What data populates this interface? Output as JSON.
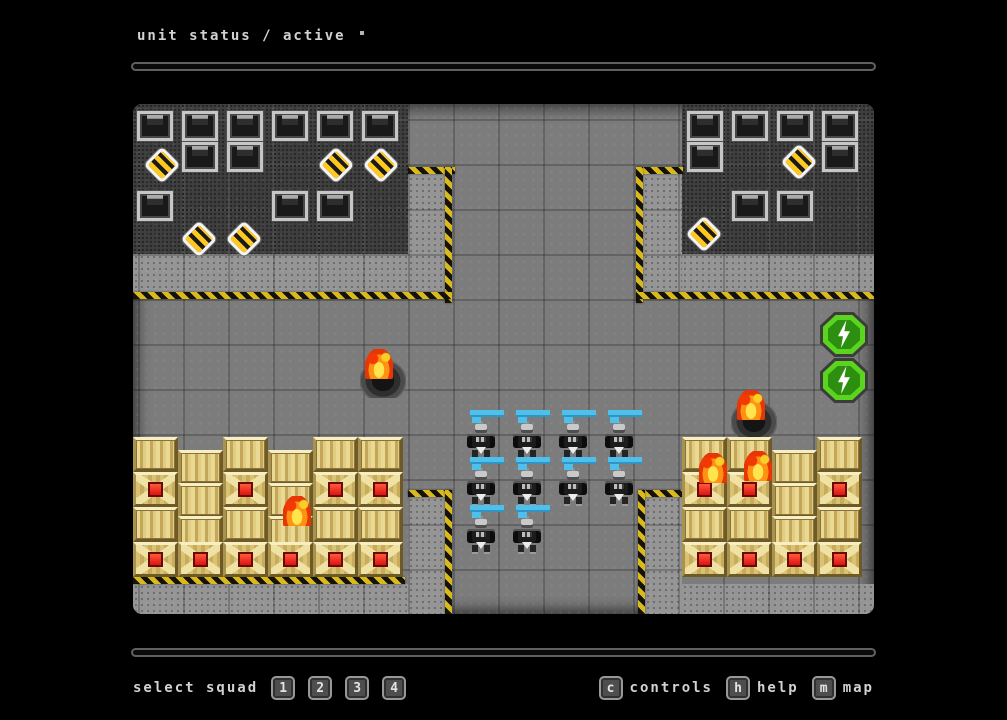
{
  "header": {
    "title": "unit status / active"
  },
  "footer": {
    "select_squad_label": "select squad",
    "squad_keys": [
      "1",
      "2",
      "3",
      "4"
    ],
    "shortcuts": [
      {
        "key": "c",
        "label": "controls"
      },
      {
        "key": "h",
        "label": "help"
      },
      {
        "key": "m",
        "label": "map"
      }
    ]
  },
  "colors": {
    "background": "#000000",
    "floor": "#7c7c7c",
    "dark_zone": "#3f3f3f",
    "concrete": "#959595",
    "hazard_yellow": "#d9b91c",
    "health_bar_cyan": "#4fc0ea",
    "energy_green": "#5bd41f",
    "fire_orange": "#ff9212",
    "crate_tan": "#d9c272",
    "crate_core_red": "#dd1212"
  },
  "board": {
    "tile_size": 45,
    "zones": [
      {
        "type": "dark",
        "x": 0,
        "y": 0,
        "w": 275,
        "h": 150
      },
      {
        "type": "dark",
        "x": 549,
        "y": 0,
        "w": 192,
        "h": 150
      },
      {
        "type": "concrete",
        "x": 275,
        "y": 66,
        "w": 42,
        "h": 129
      },
      {
        "type": "concrete",
        "x": 0,
        "y": 150,
        "w": 275,
        "h": 45
      },
      {
        "type": "concrete",
        "x": 510,
        "y": 66,
        "w": 39,
        "h": 129
      },
      {
        "type": "concrete",
        "x": 549,
        "y": 150,
        "w": 192,
        "h": 45
      },
      {
        "type": "concrete",
        "x": 275,
        "y": 393,
        "w": 37,
        "h": 117
      },
      {
        "type": "concrete",
        "x": 512,
        "y": 393,
        "w": 37,
        "h": 117
      },
      {
        "type": "concrete",
        "x": 0,
        "y": 480,
        "w": 275,
        "h": 30
      },
      {
        "type": "concrete",
        "x": 549,
        "y": 480,
        "w": 192,
        "h": 30
      }
    ],
    "hazards": [
      {
        "x": 275,
        "y": 63,
        "w": 47,
        "h": 7
      },
      {
        "x": 312,
        "y": 63,
        "w": 7,
        "h": 136
      },
      {
        "x": 0,
        "y": 188,
        "w": 319,
        "h": 7
      },
      {
        "x": 503,
        "y": 63,
        "w": 47,
        "h": 7
      },
      {
        "x": 503,
        "y": 63,
        "w": 7,
        "h": 136
      },
      {
        "x": 503,
        "y": 188,
        "w": 238,
        "h": 7
      },
      {
        "x": 275,
        "y": 386,
        "w": 44,
        "h": 7
      },
      {
        "x": 312,
        "y": 386,
        "w": 7,
        "h": 124
      },
      {
        "x": 0,
        "y": 473,
        "w": 272,
        "h": 7
      },
      {
        "x": 505,
        "y": 386,
        "w": 44,
        "h": 7
      },
      {
        "x": 505,
        "y": 386,
        "w": 7,
        "h": 124
      }
    ],
    "sprites": [
      {
        "t": "metal",
        "x": 4,
        "y": 7
      },
      {
        "t": "metal",
        "x": 49,
        "y": 7
      },
      {
        "t": "metal",
        "x": 94,
        "y": 7
      },
      {
        "t": "metal",
        "x": 139,
        "y": 7
      },
      {
        "t": "metal",
        "x": 184,
        "y": 7
      },
      {
        "t": "metal",
        "x": 229,
        "y": 7
      },
      {
        "t": "metal",
        "x": 49,
        "y": 38
      },
      {
        "t": "metal",
        "x": 94,
        "y": 38
      },
      {
        "t": "metal",
        "x": 4,
        "y": 87
      },
      {
        "t": "metal",
        "x": 139,
        "y": 87
      },
      {
        "t": "metal",
        "x": 184,
        "y": 87
      },
      {
        "t": "metal",
        "x": 554,
        "y": 7
      },
      {
        "t": "metal",
        "x": 599,
        "y": 7
      },
      {
        "t": "metal",
        "x": 644,
        "y": 7
      },
      {
        "t": "metal",
        "x": 689,
        "y": 7
      },
      {
        "t": "metal",
        "x": 554,
        "y": 38
      },
      {
        "t": "metal",
        "x": 689,
        "y": 38
      },
      {
        "t": "metal",
        "x": 599,
        "y": 87
      },
      {
        "t": "metal",
        "x": 644,
        "y": 87
      },
      {
        "t": "diamond",
        "x": 12,
        "y": 44
      },
      {
        "t": "diamond",
        "x": 186,
        "y": 44
      },
      {
        "t": "diamond",
        "x": 231,
        "y": 44
      },
      {
        "t": "diamond",
        "x": 49,
        "y": 118
      },
      {
        "t": "diamond",
        "x": 94,
        "y": 118
      },
      {
        "t": "diamond",
        "x": 649,
        "y": 41
      },
      {
        "t": "diamond",
        "x": 554,
        "y": 113
      },
      {
        "t": "energy",
        "x": 687,
        "y": 208
      },
      {
        "t": "energy",
        "x": 687,
        "y": 254
      },
      {
        "t": "crater",
        "x": 227,
        "y": 256
      },
      {
        "t": "crater",
        "x": 598,
        "y": 297
      },
      {
        "t": "crate",
        "x": 0,
        "y": 333
      },
      {
        "t": "cratex",
        "x": 0,
        "y": 368
      },
      {
        "t": "crate",
        "x": 0,
        "y": 403
      },
      {
        "t": "cratex",
        "x": 0,
        "y": 438
      },
      {
        "t": "crate",
        "x": 45,
        "y": 346
      },
      {
        "t": "crate",
        "x": 45,
        "y": 379
      },
      {
        "t": "crate",
        "x": 45,
        "y": 412
      },
      {
        "t": "cratex",
        "x": 45,
        "y": 438
      },
      {
        "t": "crate",
        "x": 90,
        "y": 333
      },
      {
        "t": "cratex",
        "x": 90,
        "y": 368
      },
      {
        "t": "crate",
        "x": 90,
        "y": 403
      },
      {
        "t": "cratex",
        "x": 90,
        "y": 438
      },
      {
        "t": "crate",
        "x": 135,
        "y": 346
      },
      {
        "t": "crate",
        "x": 135,
        "y": 379
      },
      {
        "t": "crate",
        "x": 135,
        "y": 412
      },
      {
        "t": "cratex",
        "x": 135,
        "y": 438
      },
      {
        "t": "crate",
        "x": 180,
        "y": 333
      },
      {
        "t": "cratex",
        "x": 180,
        "y": 368
      },
      {
        "t": "crate",
        "x": 180,
        "y": 403
      },
      {
        "t": "cratex",
        "x": 180,
        "y": 438
      },
      {
        "t": "crate",
        "x": 225,
        "y": 333
      },
      {
        "t": "cratex",
        "x": 225,
        "y": 368
      },
      {
        "t": "crate",
        "x": 225,
        "y": 403
      },
      {
        "t": "cratex",
        "x": 225,
        "y": 438
      },
      {
        "t": "crate",
        "x": 549,
        "y": 333
      },
      {
        "t": "cratex",
        "x": 549,
        "y": 368
      },
      {
        "t": "crate",
        "x": 549,
        "y": 403
      },
      {
        "t": "cratex",
        "x": 549,
        "y": 438
      },
      {
        "t": "crate",
        "x": 594,
        "y": 333
      },
      {
        "t": "cratex",
        "x": 594,
        "y": 368
      },
      {
        "t": "crate",
        "x": 594,
        "y": 403
      },
      {
        "t": "cratex",
        "x": 594,
        "y": 438
      },
      {
        "t": "crate",
        "x": 639,
        "y": 346
      },
      {
        "t": "crate",
        "x": 639,
        "y": 379
      },
      {
        "t": "crate",
        "x": 639,
        "y": 412
      },
      {
        "t": "cratex",
        "x": 639,
        "y": 438
      },
      {
        "t": "crate",
        "x": 684,
        "y": 333
      },
      {
        "t": "cratex",
        "x": 684,
        "y": 368
      },
      {
        "t": "crate",
        "x": 684,
        "y": 403
      },
      {
        "t": "cratex",
        "x": 684,
        "y": 438
      },
      {
        "t": "fire",
        "x": 232,
        "y": 245
      },
      {
        "t": "fire",
        "x": 604,
        "y": 286
      },
      {
        "t": "fire",
        "x": 150,
        "y": 392
      },
      {
        "t": "fire",
        "x": 566,
        "y": 349
      },
      {
        "t": "fire",
        "x": 611,
        "y": 347
      },
      {
        "t": "hbar",
        "x": 335,
        "y": 306
      },
      {
        "t": "hbar",
        "x": 381,
        "y": 306
      },
      {
        "t": "hbar",
        "x": 427,
        "y": 306
      },
      {
        "t": "hbar",
        "x": 473,
        "y": 306
      },
      {
        "t": "hbar",
        "x": 335,
        "y": 353
      },
      {
        "t": "hbar",
        "x": 381,
        "y": 353
      },
      {
        "t": "hbar",
        "x": 427,
        "y": 353
      },
      {
        "t": "hbar",
        "x": 473,
        "y": 353
      },
      {
        "t": "hbar",
        "x": 335,
        "y": 401
      },
      {
        "t": "hbar",
        "x": 381,
        "y": 401
      },
      {
        "t": "robot",
        "x": 330,
        "y": 318
      },
      {
        "t": "robot",
        "x": 376,
        "y": 318
      },
      {
        "t": "robot",
        "x": 422,
        "y": 318
      },
      {
        "t": "robot",
        "x": 468,
        "y": 318
      },
      {
        "t": "robot",
        "x": 330,
        "y": 365
      },
      {
        "t": "robot",
        "x": 376,
        "y": 365
      },
      {
        "t": "robot",
        "x": 422,
        "y": 365
      },
      {
        "t": "robot",
        "x": 468,
        "y": 365
      },
      {
        "t": "robot",
        "x": 330,
        "y": 413
      },
      {
        "t": "robot",
        "x": 376,
        "y": 413
      }
    ]
  }
}
